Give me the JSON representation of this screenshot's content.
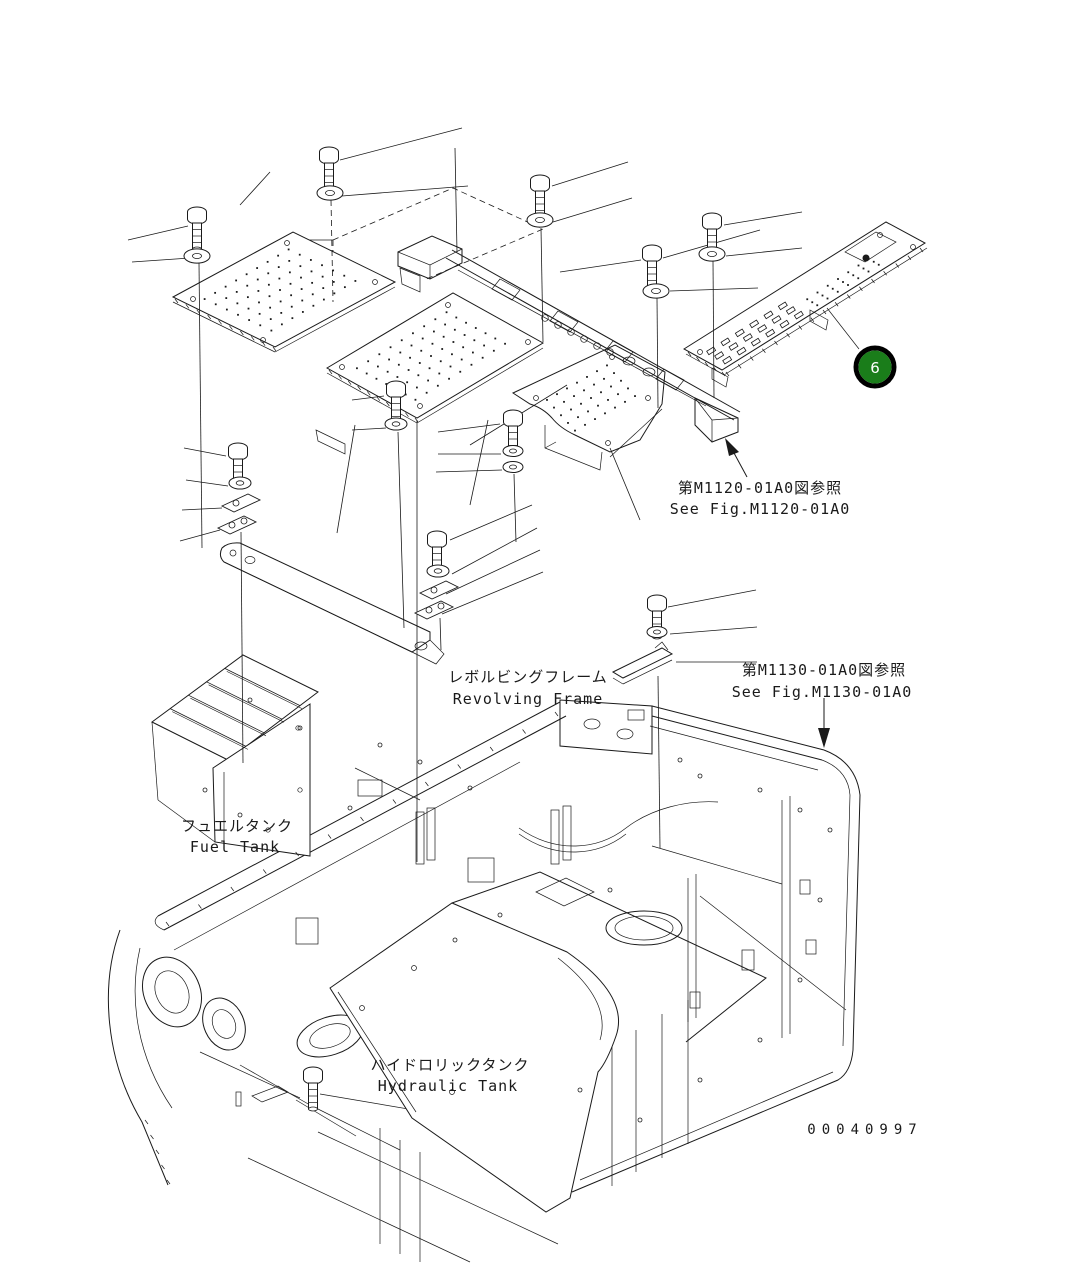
{
  "document": {
    "type": "parts-diagram",
    "drawing_number": "00040997",
    "background_color": "#ffffff",
    "line_color": "#1a1a1a"
  },
  "callouts": {
    "item6": {
      "number": "6",
      "fill_color": "#1a7d1a",
      "ring_color": "#000000",
      "text_color": "#ffffff"
    }
  },
  "references": {
    "m1120": {
      "jp": "第M1120-01A0図参照",
      "en": "See Fig.M1120-01A0"
    },
    "m1130": {
      "jp": "第M1130-01A0図参照",
      "en": "See Fig.M1130-01A0"
    }
  },
  "labels": {
    "revolving_frame": {
      "jp": "レボルビングフレーム",
      "en": "Revolving Frame"
    },
    "fuel_tank": {
      "jp": "フュエルタンク",
      "en": "Fuel Tank"
    },
    "hydraulic_tank": {
      "jp": "ハイドロリックタンク",
      "en": "Hydraulic Tank"
    }
  }
}
